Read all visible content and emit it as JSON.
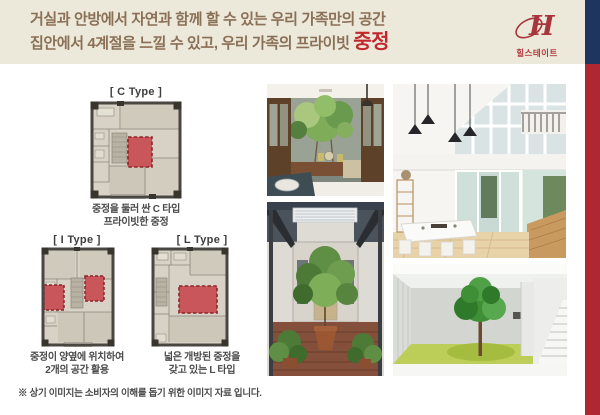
{
  "header": {
    "line1": "거실과 안방에서 자연과 함께 할 수 있는 우리 가족만의 공간",
    "line2_prefix": "집안에서 4계절을 느낄 수 있고, 우리 가족의 프라이빗 ",
    "line2_highlight": "중정"
  },
  "logo": {
    "monogram": "H",
    "brand": "힐스테이트"
  },
  "floorplans": [
    {
      "label": "[ C Type ]",
      "caption1": "중정을 둘러 싼 C 타입",
      "caption2": "프라이빗한 중정"
    },
    {
      "label": "[ I Type ]",
      "caption1": "중정이 양옆에 위치하여",
      "caption2": "2개의 공간 활용"
    },
    {
      "label": "[ L Type ]",
      "caption1": "넓은 개방된 중정을",
      "caption2": "갖고 있는 L 타입"
    }
  ],
  "footer": {
    "disclaimer": "※ 상기 이미지는 소비자의 이해를 돕기 위한 이미지 자료 입니다."
  },
  "colors": {
    "top_band": "#ECE8DA",
    "headline_brown": "#8A7056",
    "highlight_red": "#C1272D",
    "logo_red": "#A8343C",
    "stripe_navy": "#1E3560",
    "stripe_red": "#AF2733",
    "plan_courtyard_red": "#C8565B",
    "plan_wall": "#4A4742",
    "caption_gray": "#4A4A4A"
  }
}
